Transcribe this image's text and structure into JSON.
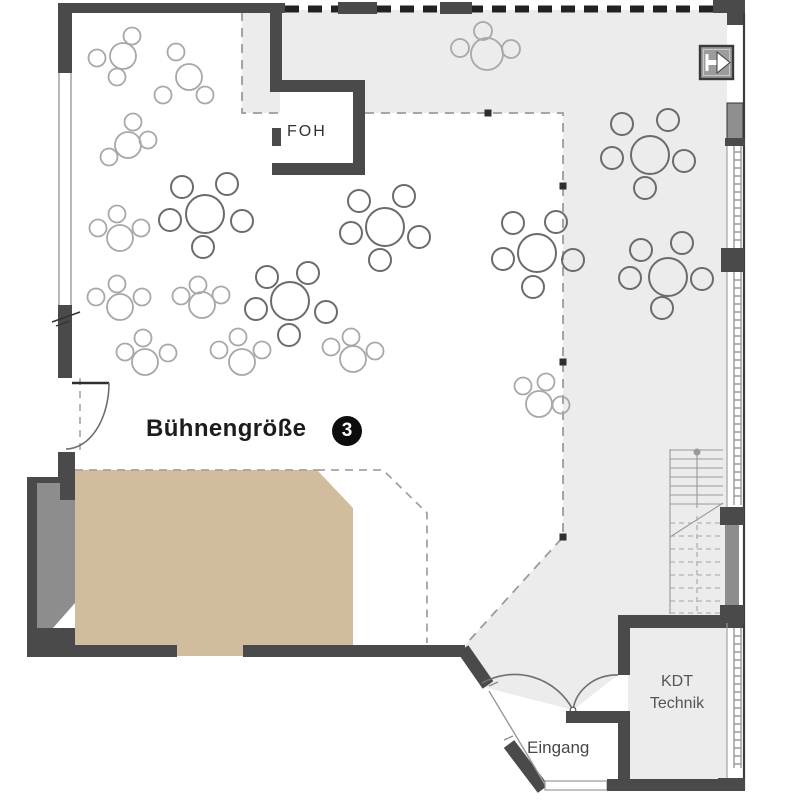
{
  "title": "Veranstaltungssaal Grundriss — Bühnengröße 3",
  "labels": {
    "stage": "Bühnengröße",
    "stage_badge": "3",
    "foh": "FOH",
    "kdt_line1": "KDT",
    "kdt_line2": "Technik",
    "entrance": "Eingang"
  },
  "colors": {
    "wall": "#4a4a4a",
    "wall_medium": "#8d8d8d",
    "floor_gray": "#ececec",
    "stage": "#d2bc9e",
    "table_dark": "#6b6b6b",
    "table_light": "#a8a8a8",
    "text_dark": "#1c1c1c",
    "text_mid": "#555555"
  },
  "boundary_markers": [
    [
      488,
      113
    ],
    [
      563,
      186
    ],
    [
      563,
      362
    ],
    [
      563,
      537
    ]
  ],
  "tables": [
    {
      "x": 205,
      "y": 214,
      "r": 19,
      "chair_r": 11,
      "tone": "dark",
      "seats": 6,
      "chairs": [
        [
          182,
          187
        ],
        [
          227,
          184
        ],
        [
          170,
          220
        ],
        [
          242,
          221
        ],
        [
          203,
          247
        ]
      ]
    },
    {
      "x": 290,
      "y": 301,
      "r": 19,
      "chair_r": 11,
      "tone": "dark",
      "seats": 6,
      "chairs": [
        [
          267,
          277
        ],
        [
          308,
          273
        ],
        [
          256,
          309
        ],
        [
          326,
          312
        ],
        [
          289,
          335
        ]
      ]
    },
    {
      "x": 385,
      "y": 227,
      "r": 19,
      "chair_r": 11,
      "tone": "dark",
      "seats": 6,
      "chairs": [
        [
          359,
          201
        ],
        [
          404,
          196
        ],
        [
          351,
          233
        ],
        [
          419,
          237
        ],
        [
          380,
          260
        ]
      ]
    },
    {
      "x": 537,
      "y": 253,
      "r": 19,
      "chair_r": 11,
      "tone": "dark",
      "seats": 6,
      "chairs": [
        [
          513,
          223
        ],
        [
          556,
          222
        ],
        [
          503,
          259
        ],
        [
          573,
          260
        ],
        [
          533,
          287
        ]
      ]
    },
    {
      "x": 650,
      "y": 155,
      "r": 19,
      "chair_r": 11,
      "tone": "dark",
      "seats": 6,
      "chairs": [
        [
          622,
          124
        ],
        [
          668,
          120
        ],
        [
          612,
          158
        ],
        [
          684,
          161
        ],
        [
          645,
          188
        ]
      ]
    },
    {
      "x": 668,
      "y": 277,
      "r": 19,
      "chair_r": 11,
      "tone": "dark",
      "seats": 6,
      "chairs": [
        [
          641,
          250
        ],
        [
          682,
          243
        ],
        [
          630,
          278
        ],
        [
          702,
          279
        ],
        [
          662,
          308
        ]
      ]
    },
    {
      "x": 123,
      "y": 56,
      "r": 13,
      "chair_r": 8.5,
      "tone": "light",
      "seats": 4,
      "chairs": [
        [
          97,
          58
        ],
        [
          132,
          36
        ],
        [
          117,
          77
        ]
      ]
    },
    {
      "x": 189,
      "y": 77,
      "r": 13,
      "chair_r": 8.5,
      "tone": "light",
      "seats": 4,
      "chairs": [
        [
          176,
          52
        ],
        [
          205,
          95
        ],
        [
          163,
          95
        ]
      ]
    },
    {
      "x": 128,
      "y": 145,
      "r": 13,
      "chair_r": 8.5,
      "tone": "light",
      "seats": 4,
      "chairs": [
        [
          133,
          122
        ],
        [
          109,
          157
        ],
        [
          148,
          140
        ]
      ]
    },
    {
      "x": 487,
      "y": 54,
      "r": 16,
      "chair_r": 9,
      "tone": "light",
      "seats": 4,
      "chairs": [
        [
          460,
          48
        ],
        [
          483,
          31
        ],
        [
          511,
          49
        ]
      ]
    },
    {
      "x": 120,
      "y": 238,
      "r": 13,
      "chair_r": 8.5,
      "tone": "light",
      "seats": 4,
      "chairs": [
        [
          98,
          228
        ],
        [
          117,
          214
        ],
        [
          141,
          228
        ]
      ]
    },
    {
      "x": 120,
      "y": 307,
      "r": 13,
      "chair_r": 8.5,
      "tone": "light",
      "seats": 4,
      "chairs": [
        [
          96,
          297
        ],
        [
          117,
          284
        ],
        [
          142,
          297
        ]
      ]
    },
    {
      "x": 202,
      "y": 305,
      "r": 13,
      "chair_r": 8.5,
      "tone": "light",
      "seats": 4,
      "chairs": [
        [
          181,
          296
        ],
        [
          198,
          285
        ],
        [
          221,
          295
        ]
      ]
    },
    {
      "x": 145,
      "y": 362,
      "r": 13,
      "chair_r": 8.5,
      "tone": "light",
      "seats": 4,
      "chairs": [
        [
          125,
          352
        ],
        [
          143,
          338
        ],
        [
          168,
          353
        ]
      ]
    },
    {
      "x": 242,
      "y": 362,
      "r": 13,
      "chair_r": 8.5,
      "tone": "light",
      "seats": 4,
      "chairs": [
        [
          219,
          350
        ],
        [
          238,
          337
        ],
        [
          262,
          350
        ]
      ]
    },
    {
      "x": 353,
      "y": 359,
      "r": 13,
      "chair_r": 8.5,
      "tone": "light",
      "seats": 4,
      "chairs": [
        [
          331,
          347
        ],
        [
          351,
          337
        ],
        [
          375,
          351
        ]
      ]
    },
    {
      "x": 539,
      "y": 404,
      "r": 13,
      "chair_r": 8.5,
      "tone": "light",
      "seats": 4,
      "chairs": [
        [
          523,
          386
        ],
        [
          546,
          382
        ],
        [
          561,
          405
        ]
      ]
    }
  ]
}
